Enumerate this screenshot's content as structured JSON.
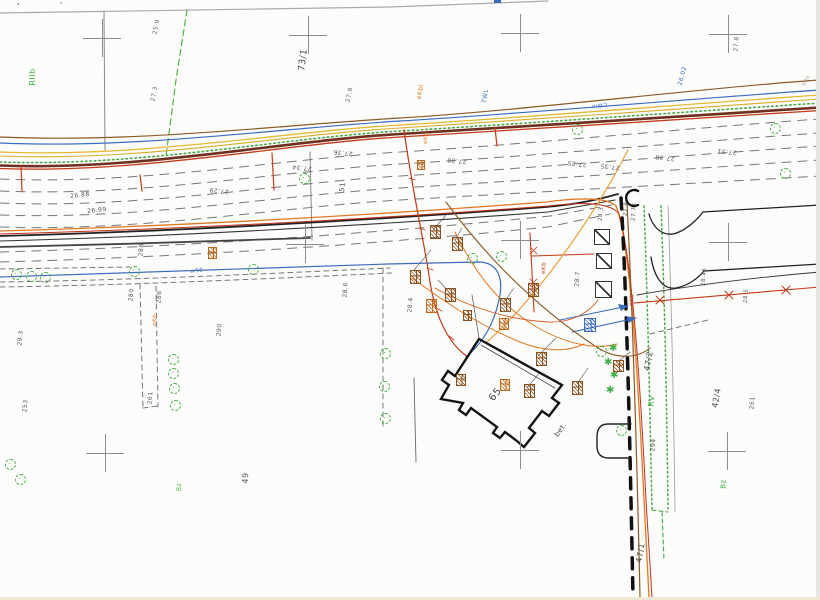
{
  "plan": {
    "colors": {
      "paper": "#fcfcfa",
      "gas_yellow": "#e3b92e",
      "water_blue": "#3a6bbf",
      "power_orange": "#e07820",
      "power_red": "#c43a1a",
      "telecom_brown": "#8a5a28",
      "vegetation_green": "#3fae49",
      "road_edge_dark": "#6e2f1e"
    },
    "labels": [
      {
        "text": "73/1",
        "x": 304,
        "y": 60,
        "rot": -83,
        "color": "#444",
        "size": 9
      },
      {
        "text": "RIIb",
        "x": 33,
        "y": 77,
        "rot": -90,
        "color": "#3fae49",
        "size": 8
      },
      {
        "text": "25.9",
        "x": 157,
        "y": 27,
        "rot": -78,
        "color": "#666",
        "size": 6
      },
      {
        "text": "27.3",
        "x": 155,
        "y": 94,
        "rot": -78,
        "color": "#666",
        "size": 6
      },
      {
        "text": "27.8",
        "x": 350,
        "y": 95,
        "rot": -78,
        "color": "#666",
        "size": 6
      },
      {
        "text": "eKbl",
        "x": 421,
        "y": 92,
        "rot": -80,
        "color": "#e07820",
        "size": 6
      },
      {
        "text": "TWL",
        "x": 486,
        "y": 96,
        "rot": -80,
        "color": "#3a6bbf",
        "size": 6
      },
      {
        "text": "26.02",
        "x": 683,
        "y": 76,
        "rot": -75,
        "color": "#3a6bbf",
        "size": 6
      },
      {
        "text": "27.8",
        "x": 737,
        "y": 44,
        "rot": -85,
        "color": "#666",
        "size": 6
      },
      {
        "text": "CWm",
        "x": 599,
        "y": 104,
        "rot": 170,
        "color": "#3a6bbf",
        "size": 5.5
      },
      {
        "text": "26.88",
        "x": 80,
        "y": 196,
        "rot": -6,
        "color": "#555",
        "size": 6
      },
      {
        "text": "26.99",
        "x": 97,
        "y": 211,
        "rot": -6,
        "color": "#555",
        "size": 6
      },
      {
        "text": "27.29",
        "x": 219,
        "y": 190,
        "rot": 186,
        "color": "#555",
        "size": 6
      },
      {
        "text": "27.34",
        "x": 302,
        "y": 167,
        "rot": 186,
        "color": "#555",
        "size": 6
      },
      {
        "text": "27.36",
        "x": 343,
        "y": 152,
        "rot": 186,
        "color": "#555",
        "size": 6
      },
      {
        "text": "27.30",
        "x": 457,
        "y": 160,
        "rot": 186,
        "color": "#555",
        "size": 6
      },
      {
        "text": "27.25",
        "x": 577,
        "y": 163,
        "rot": 186,
        "color": "#555",
        "size": 6
      },
      {
        "text": "27.35",
        "x": 610,
        "y": 166,
        "rot": 186,
        "color": "#555",
        "size": 6
      },
      {
        "text": "27.30",
        "x": 665,
        "y": 157,
        "rot": 186,
        "color": "#555",
        "size": 6
      },
      {
        "text": "27.31",
        "x": 727,
        "y": 151,
        "rot": 186,
        "color": "#555",
        "size": 6
      },
      {
        "text": "51",
        "x": 343,
        "y": 187,
        "rot": -85,
        "color": "#555",
        "size": 7
      },
      {
        "text": "27.73",
        "x": 635,
        "y": 212,
        "rot": -85,
        "color": "#555",
        "size": 5.5
      },
      {
        "text": "28.3",
        "x": 602,
        "y": 214,
        "rot": -85,
        "color": "#555",
        "size": 5.5
      },
      {
        "text": "27.8",
        "x": 627,
        "y": 209,
        "rot": -85,
        "color": "#555",
        "size": 5.5
      },
      {
        "text": "28.7",
        "x": 578,
        "y": 279,
        "rot": -85,
        "color": "#555",
        "size": 6
      },
      {
        "text": "28.45",
        "x": 705,
        "y": 277,
        "rot": -85,
        "color": "#555",
        "size": 5.5
      },
      {
        "text": "28.5",
        "x": 747,
        "y": 296,
        "rot": -85,
        "color": "#555",
        "size": 5.5
      },
      {
        "text": "28.6",
        "x": 346,
        "y": 290,
        "rot": -85,
        "color": "#555",
        "size": 6
      },
      {
        "text": "28.4",
        "x": 411,
        "y": 305,
        "rot": -85,
        "color": "#555",
        "size": 6
      },
      {
        "text": "65",
        "x": 496,
        "y": 395,
        "rot": -52,
        "color": "#444",
        "size": 10
      },
      {
        "text": "bet.",
        "x": 561,
        "y": 430,
        "rot": -55,
        "color": "#444",
        "size": 7
      },
      {
        "text": "49",
        "x": 246,
        "y": 478,
        "rot": -87,
        "color": "#555",
        "size": 8
      },
      {
        "text": "Bz",
        "x": 180,
        "y": 487,
        "rot": -90,
        "color": "#3fae49",
        "size": 6
      },
      {
        "text": "Bz",
        "x": 724,
        "y": 484,
        "rot": -90,
        "color": "#3fae49",
        "size": 7
      },
      {
        "text": "47/2",
        "x": 649,
        "y": 361,
        "rot": -80,
        "color": "#444",
        "size": 8
      },
      {
        "text": "RV",
        "x": 652,
        "y": 401,
        "rot": -85,
        "color": "#3fae49",
        "size": 8
      },
      {
        "text": "294",
        "x": 654,
        "y": 445,
        "rot": -85,
        "color": "#555",
        "size": 6
      },
      {
        "text": "42/4",
        "x": 717,
        "y": 398,
        "rot": -80,
        "color": "#444",
        "size": 8
      },
      {
        "text": "261",
        "x": 753,
        "y": 403,
        "rot": -85,
        "color": "#555",
        "size": 6
      },
      {
        "text": "47/1",
        "x": 641,
        "y": 553,
        "rot": -80,
        "color": "#444",
        "size": 8
      },
      {
        "text": "261",
        "x": 151,
        "y": 398,
        "rot": -85,
        "color": "#555",
        "size": 6
      },
      {
        "text": "253",
        "x": 26,
        "y": 406,
        "rot": -85,
        "color": "#555",
        "size": 6
      },
      {
        "text": "29.3",
        "x": 21,
        "y": 338,
        "rot": -85,
        "color": "#555",
        "size": 6
      },
      {
        "text": "290",
        "x": 220,
        "y": 330,
        "rot": -85,
        "color": "#555",
        "size": 6
      },
      {
        "text": "280",
        "x": 132,
        "y": 295,
        "rot": -85,
        "color": "#555",
        "size": 6
      },
      {
        "text": "286",
        "x": 160,
        "y": 297,
        "rot": -85,
        "color": "#555",
        "size": 6
      },
      {
        "text": "288",
        "x": 142,
        "y": 250,
        "rot": -85,
        "color": "#555",
        "size": 6
      },
      {
        "text": "w90",
        "x": 197,
        "y": 272,
        "rot": -5,
        "color": "#3a6bbf",
        "size": 5.5
      },
      {
        "text": "000",
        "x": 807,
        "y": 81,
        "rot": -60,
        "color": "#998",
        "size": 5
      },
      {
        "text": "eKb",
        "x": 156,
        "y": 320,
        "rot": -85,
        "color": "#e07820",
        "size": 5.5
      },
      {
        "text": "eKb",
        "x": 633,
        "y": 300,
        "rot": -85,
        "color": "#c43a1a",
        "size": 5.5
      },
      {
        "text": "eKb",
        "x": 545,
        "y": 268,
        "rot": -85,
        "color": "#c43a1a",
        "size": 5.5
      },
      {
        "text": "eKb",
        "x": 427,
        "y": 138,
        "rot": -85,
        "color": "#e07820",
        "size": 5.5
      }
    ],
    "symbols": {
      "crosses": [
        {
          "x": 102,
          "y": 38
        },
        {
          "x": 308,
          "y": 35
        },
        {
          "x": 520,
          "y": 33
        },
        {
          "x": 728,
          "y": 34
        },
        {
          "x": 305,
          "y": 244
        },
        {
          "x": 520,
          "y": 240
        },
        {
          "x": 728,
          "y": 242
        },
        {
          "x": 105,
          "y": 453
        },
        {
          "x": 520,
          "y": 450
        },
        {
          "x": 727,
          "y": 451
        }
      ],
      "trees": [
        {
          "x": 15,
          "y": 273
        },
        {
          "x": 30,
          "y": 275
        },
        {
          "x": 44,
          "y": 276
        },
        {
          "x": 133,
          "y": 270
        },
        {
          "x": 252,
          "y": 268
        },
        {
          "x": 303,
          "y": 177
        },
        {
          "x": 384,
          "y": 352
        },
        {
          "x": 383,
          "y": 385
        },
        {
          "x": 384,
          "y": 417
        },
        {
          "x": 172,
          "y": 358
        },
        {
          "x": 172,
          "y": 372
        },
        {
          "x": 173,
          "y": 387
        },
        {
          "x": 174,
          "y": 404
        },
        {
          "x": 471,
          "y": 257
        },
        {
          "x": 500,
          "y": 255
        },
        {
          "x": 576,
          "y": 128
        },
        {
          "x": 774,
          "y": 127
        },
        {
          "x": 784,
          "y": 172
        },
        {
          "x": 600,
          "y": 350
        },
        {
          "x": 620,
          "y": 429
        },
        {
          "x": 9,
          "y": 463
        },
        {
          "x": 19,
          "y": 478
        }
      ],
      "conifers": [
        {
          "x": 614,
          "y": 349
        },
        {
          "x": 609,
          "y": 363
        },
        {
          "x": 615,
          "y": 376
        },
        {
          "x": 611,
          "y": 391
        }
      ],
      "hatch_boxes": [
        {
          "x": 430,
          "y": 225,
          "w": 11,
          "h": 14,
          "color": "#8a5020"
        },
        {
          "x": 410,
          "y": 270,
          "w": 11,
          "h": 14,
          "color": "#8a5020"
        },
        {
          "x": 452,
          "y": 237,
          "w": 11,
          "h": 14,
          "color": "#8a5020"
        },
        {
          "x": 445,
          "y": 288,
          "w": 11,
          "h": 14,
          "color": "#8a5020"
        },
        {
          "x": 426,
          "y": 299,
          "w": 11,
          "h": 14,
          "color": "#c06818"
        },
        {
          "x": 500,
          "y": 298,
          "w": 11,
          "h": 14,
          "color": "#8a5020"
        },
        {
          "x": 528,
          "y": 283,
          "w": 11,
          "h": 14,
          "color": "#8a5020"
        },
        {
          "x": 499,
          "y": 318,
          "w": 10,
          "h": 12,
          "color": "#c06818"
        },
        {
          "x": 536,
          "y": 352,
          "w": 11,
          "h": 14,
          "color": "#8a5020"
        },
        {
          "x": 524,
          "y": 384,
          "w": 11,
          "h": 14,
          "color": "#8a5020"
        },
        {
          "x": 500,
          "y": 379,
          "w": 10,
          "h": 12,
          "color": "#c06818"
        },
        {
          "x": 456,
          "y": 374,
          "w": 10,
          "h": 12,
          "color": "#8a5020"
        },
        {
          "x": 572,
          "y": 381,
          "w": 11,
          "h": 14,
          "color": "#8a5020"
        },
        {
          "x": 613,
          "y": 360,
          "w": 11,
          "h": 12,
          "color": "#8a5020"
        },
        {
          "x": 584,
          "y": 318,
          "w": 12,
          "h": 14,
          "color": "#3a6bbf"
        },
        {
          "x": 208,
          "y": 247,
          "w": 9,
          "h": 12,
          "color": "#c06818"
        },
        {
          "x": 417,
          "y": 160,
          "w": 8,
          "h": 10,
          "color": "#c06818"
        },
        {
          "x": 463,
          "y": 310,
          "w": 9,
          "h": 11,
          "color": "#8a5020"
        }
      ],
      "slash_boxes": [
        {
          "x": 594,
          "y": 229,
          "s": 16
        },
        {
          "x": 596,
          "y": 253,
          "s": 16
        },
        {
          "x": 595,
          "y": 281,
          "s": 17
        }
      ]
    }
  }
}
